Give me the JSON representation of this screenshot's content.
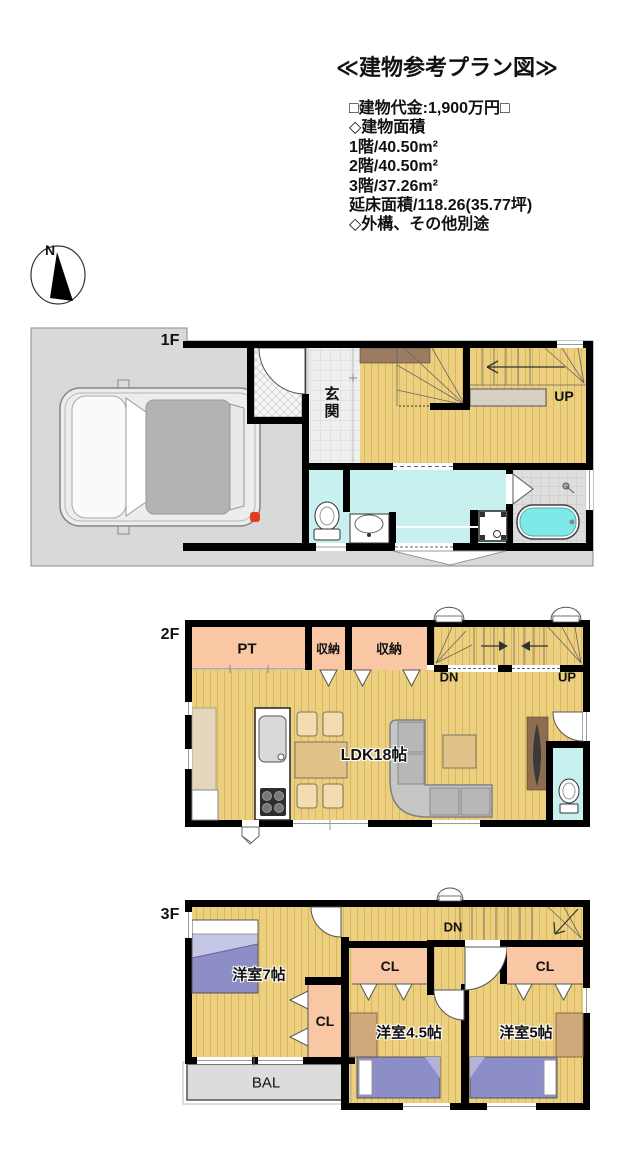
{
  "header": {
    "title": "≪建物参考プラン図≫",
    "info_lines": [
      "□建物代金:1,900万円□",
      "◇建物面積",
      "1階/40.50m²",
      "2階/40.50m²",
      "3階/37.26m²",
      "延床面積/118.26(35.77坪)",
      "◇外構、その他別途"
    ]
  },
  "compass": {
    "north_label": "N"
  },
  "floors": {
    "f1": {
      "label": "1F",
      "genkan": "玄関",
      "up": "UP"
    },
    "f2": {
      "label": "2F",
      "pt": "PT",
      "closet1": "収納",
      "closet2": "収納",
      "dn": "DN",
      "up": "UP",
      "ldk": "LDK18帖"
    },
    "f3": {
      "label": "3F",
      "room7": "洋室7帖",
      "dn": "DN",
      "cl_mid": "CL",
      "cl_right": "CL",
      "cl_left": "CL",
      "room45": "洋室4.5帖",
      "room5": "洋室5帖",
      "bal": "BAL"
    }
  },
  "colors": {
    "wood": "#edd07f",
    "salmon": "#f9c7a4",
    "cyan": "#c7f0ee",
    "tub": "#7de9e9",
    "purple": "#8d8dc8",
    "purple_light": "#c6c6e6",
    "parcel": "#d9d9d9",
    "bal": "#dcdcdc",
    "brown": "#9b7b62",
    "tv_panel": "#8f6d50",
    "desk": "#cfa87c",
    "counter": "#e6d6bc",
    "table": "#e3c289",
    "chair": "#f3ddb0",
    "sofa": "#c6c6c6",
    "under_stair": "#d8d0c3",
    "tail_red": "#e23b20",
    "wall": "#000000"
  }
}
